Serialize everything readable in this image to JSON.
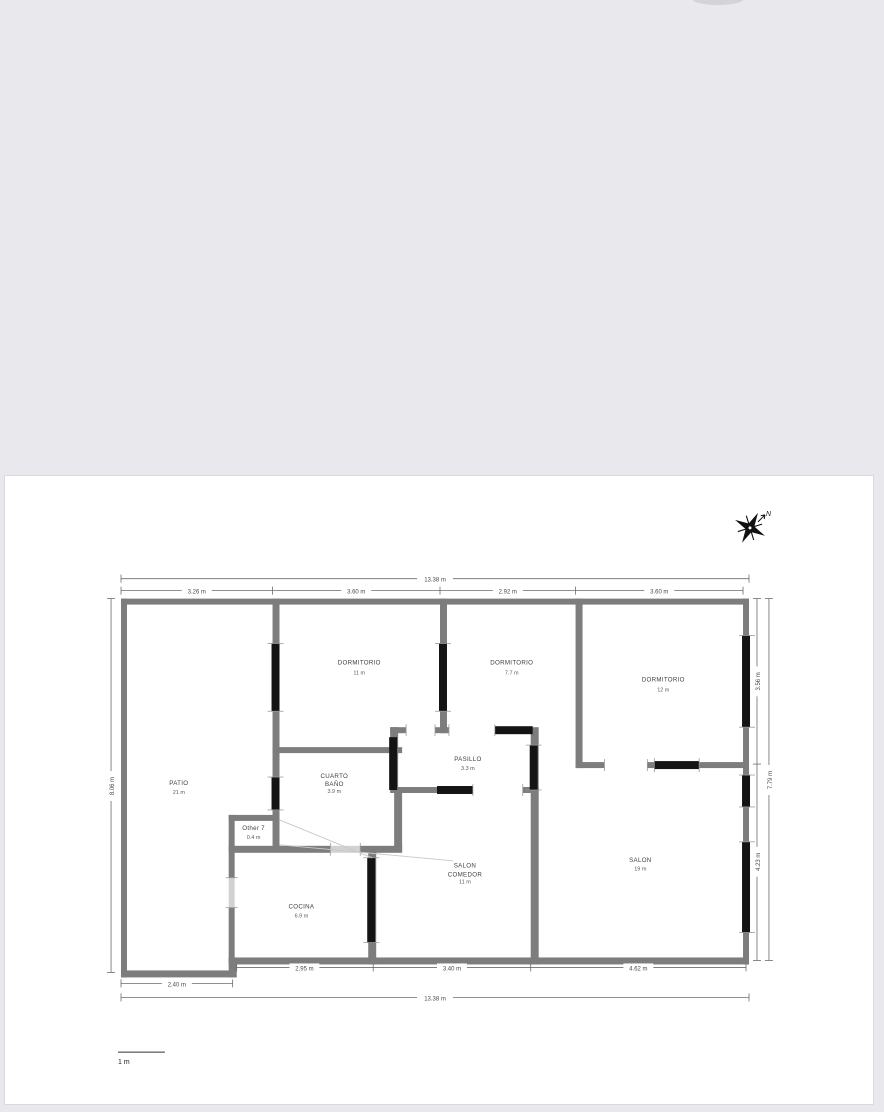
{
  "viewer": {
    "background_color": "#e9e9ed",
    "page_color": "#ffffff"
  },
  "compass": {
    "north": "N"
  },
  "scalebar": {
    "label": "1 m"
  },
  "floorplan": {
    "colors": {
      "wall": "#7d7d7d",
      "window": "#141414",
      "label_text": "#3f3f3f",
      "dimension_text": "#4a4a4a"
    },
    "rooms": [
      {
        "name": "PATIO",
        "area": "21 m"
      },
      {
        "name": "DORMITORIO",
        "area": "11 m"
      },
      {
        "name": "DORMITORIO",
        "area": "7.7 m"
      },
      {
        "name": "DORMITORIO",
        "area": "12 m"
      },
      {
        "line1": "CUARTO",
        "line2": "BAÑO",
        "area": "3.9 m"
      },
      {
        "name": "PASILLO",
        "area": "3.3 m"
      },
      {
        "name": "Other 7",
        "area": "0.4 m"
      },
      {
        "line1": "SALON",
        "line2": "COMEDOR",
        "area": "11 m"
      },
      {
        "name": "SALON",
        "area": "19 m"
      },
      {
        "name": "COCINA",
        "area": "6.9 m"
      }
    ],
    "dims": {
      "top_total": "13.38 m",
      "top_seg1": "3.26 m",
      "top_seg2": "3.60 m",
      "top_seg3": "2.92 m",
      "top_seg4": "3.60 m",
      "bottom_seg1": "2.95 m",
      "bottom_seg2": "3.40 m",
      "bottom_seg3": "4.62 m",
      "bottom_patio": "2.40 m",
      "bottom_total": "13.38 m",
      "left_total": "8.06 m",
      "right_seg1": "3.56 m",
      "right_seg2": "4.23 m",
      "right_total": "7.79 m"
    }
  }
}
